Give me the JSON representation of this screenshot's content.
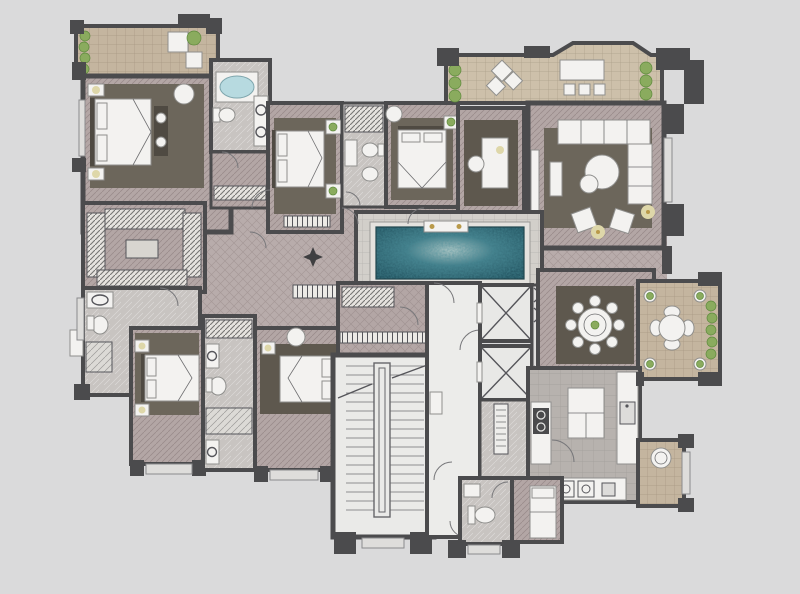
{
  "meta": {
    "type": "residential apartment floor plan"
  },
  "palette": {
    "bg": "#dadadb",
    "wall": "#4b4b4d",
    "floor_room": "#b3a6a5",
    "floor_hall": "#b8acab",
    "floor_bath": "#c8c4c1",
    "floor_light": "#eaeae8",
    "floor_kitchen": "#b7b2ae",
    "terrace": "#c4b59f",
    "terrace2": "#cdc0aa",
    "rug": "#6c665b",
    "rug_dark": "#5e584e",
    "plant": "#8aab5e",
    "plant_dark": "#5e8a3d",
    "furniture": "#f3f2f0",
    "furniture_line": "#8f8f8d",
    "wood": "#4f4a42",
    "glow": "#ded7a9",
    "gold": "#b99a4a",
    "tub": "#b7dae0",
    "pool_deep": "#1d4c59",
    "pool_mid": "#2f6d7b",
    "pool_light": "#c0d1ce"
  },
  "elements": [
    {
      "name": "planted-balcony-top-left",
      "kind": "outdoor"
    },
    {
      "name": "master-bedroom",
      "kind": "room"
    },
    {
      "name": "master-bathroom-with-tub",
      "kind": "room"
    },
    {
      "name": "walk-in-closet",
      "kind": "room"
    },
    {
      "name": "bedroom-2",
      "kind": "room"
    },
    {
      "name": "shared-bathroom",
      "kind": "room"
    },
    {
      "name": "bedroom-3",
      "kind": "room"
    },
    {
      "name": "study",
      "kind": "room"
    },
    {
      "name": "roof-terrace-lounge",
      "kind": "outdoor"
    },
    {
      "name": "living-room",
      "kind": "room"
    },
    {
      "name": "swimming-pool",
      "kind": "water"
    },
    {
      "name": "hallway",
      "kind": "circulation"
    },
    {
      "name": "bathroom-left-wing",
      "kind": "room"
    },
    {
      "name": "bedroom-4",
      "kind": "room"
    },
    {
      "name": "jack-and-jill-bathroom",
      "kind": "room"
    },
    {
      "name": "bedroom-5",
      "kind": "room"
    },
    {
      "name": "foyer",
      "kind": "circulation"
    },
    {
      "name": "stairwell",
      "kind": "core"
    },
    {
      "name": "elevator-lobby",
      "kind": "core"
    },
    {
      "name": "elevator-shafts",
      "kind": "core"
    },
    {
      "name": "dining-room",
      "kind": "room"
    },
    {
      "name": "dining-terrace",
      "kind": "outdoor"
    },
    {
      "name": "kitchen",
      "kind": "room"
    },
    {
      "name": "pantry-corridor",
      "kind": "room"
    },
    {
      "name": "powder-room",
      "kind": "room"
    },
    {
      "name": "maid-room",
      "kind": "room"
    },
    {
      "name": "laundry-balcony",
      "kind": "outdoor"
    }
  ],
  "counts": {
    "bedrooms": 5,
    "elevators": 2,
    "dining_seats": 8,
    "terrace_seats": 4
  }
}
